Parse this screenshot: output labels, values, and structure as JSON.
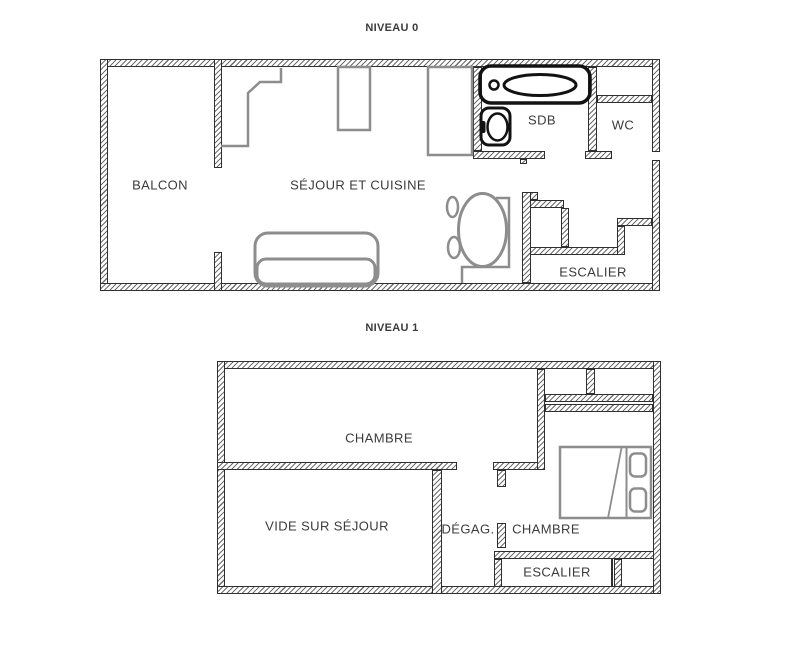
{
  "colors": {
    "background": "#ffffff",
    "wall_line": "#2f2f2f",
    "hatch": "#6e6e6e",
    "furniture_gray": "#8d8d8d",
    "fixture_black": "#121212",
    "text": "#3b3b3b"
  },
  "levels": [
    {
      "title": "NIVEAU 0",
      "rooms": [
        {
          "name": "balcon",
          "label": "BALCON"
        },
        {
          "name": "sejour-cuisine",
          "label": "SÉJOUR ET CUISINE"
        },
        {
          "name": "sdb",
          "label": "SDB"
        },
        {
          "name": "wc",
          "label": "WC"
        },
        {
          "name": "escalier",
          "label": "ESCALIER"
        }
      ],
      "furniture_icons": [
        "bathtub-icon",
        "sink-icon",
        "kitchen-counter-icon",
        "kitchen-unit-icon",
        "appliance-icon",
        "dining-table-icon",
        "chair-icon",
        "sofa-icon",
        "desk-icon"
      ]
    },
    {
      "title": "NIVEAU 1",
      "rooms": [
        {
          "name": "chambre-1",
          "label": "CHAMBRE"
        },
        {
          "name": "vide-sur-sejour",
          "label": "VIDE SUR SÉJOUR"
        },
        {
          "name": "degagement",
          "label": "DÉGAG."
        },
        {
          "name": "chambre-2",
          "label": "CHAMBRE"
        },
        {
          "name": "escalier",
          "label": "ESCALIER"
        }
      ],
      "furniture_icons": [
        "double-bed-icon"
      ]
    }
  ]
}
